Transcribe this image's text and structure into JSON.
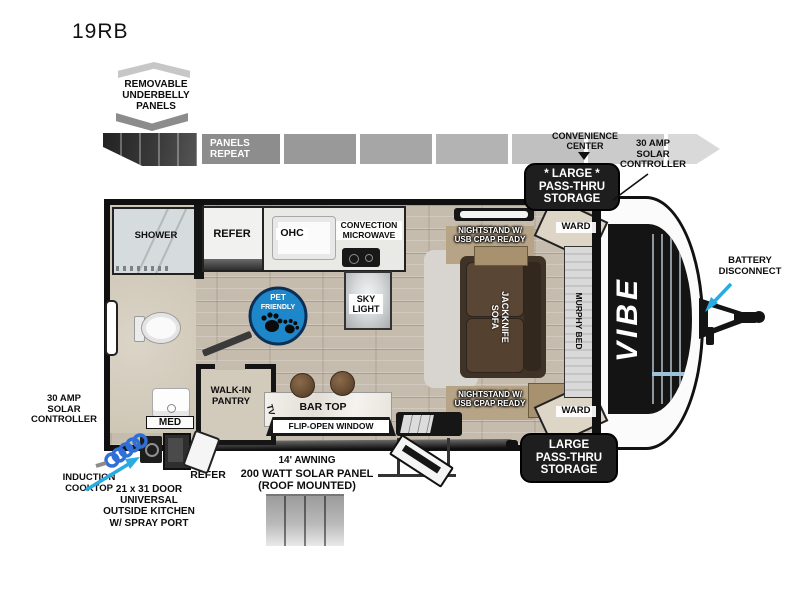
{
  "title": "19RB",
  "brand": "VIBE",
  "top": {
    "underbelly": "REMOVABLE\nUNDERBELLY\nPANELS",
    "panels_repeat": "PANELS\nREPEAT",
    "convenience_center": "CONVENIENCE\nCENTER",
    "solar_controller": "30 AMP\nSOLAR\nCONTROLLER",
    "storage_front": "* LARGE *\nPASS-THRU\nSTORAGE"
  },
  "exterior": {
    "storage_rear": "LARGE\nPASS-THRU\nSTORAGE",
    "battery": "BATTERY\nDISCONNECT",
    "awning": "14' AWNING",
    "solar_panel": "200 WATT SOLAR PANEL\n(ROOF MOUNTED)",
    "outside_refer": "REFER",
    "induction": "INDUCTION\nCOOKTOP",
    "outside_kitchen": "21 x 31 DOOR\nUNIVERSAL\nOUTSIDE KITCHEN\nW/ SPRAY PORT",
    "solar_controller": "30 AMP\nSOLAR\nCONTROLLER"
  },
  "interior": {
    "shower": "SHOWER",
    "refer": "REFER",
    "ohc": "OHC",
    "microwave": "CONVECTION\nMICROWAVE",
    "skylight": "SKY\nLIGHT",
    "nightstand_top": "NIGHTSTAND W/\nUSB CPAP READY",
    "nightstand_bottom": "NIGHTSTAND W/\nUSB CPAP READY",
    "ward_top": "WARD",
    "ward_bottom": "WARD",
    "murphy_bed": "MURPHY BED",
    "sofa": "JACKKNIFE\nSOFA",
    "pantry": "WALK-IN\nPANTRY",
    "med": "MED",
    "tv": "TV",
    "bar_top": "BAR TOP",
    "flip_window": "FLIP-OPEN WINDOW"
  },
  "badge": {
    "line1": "PET",
    "line2": "FRIENDLY"
  },
  "colors": {
    "accent_cyan": "#29abe2",
    "badge_blue": "#1d87c9",
    "tag_black": "#1e1e1e"
  }
}
